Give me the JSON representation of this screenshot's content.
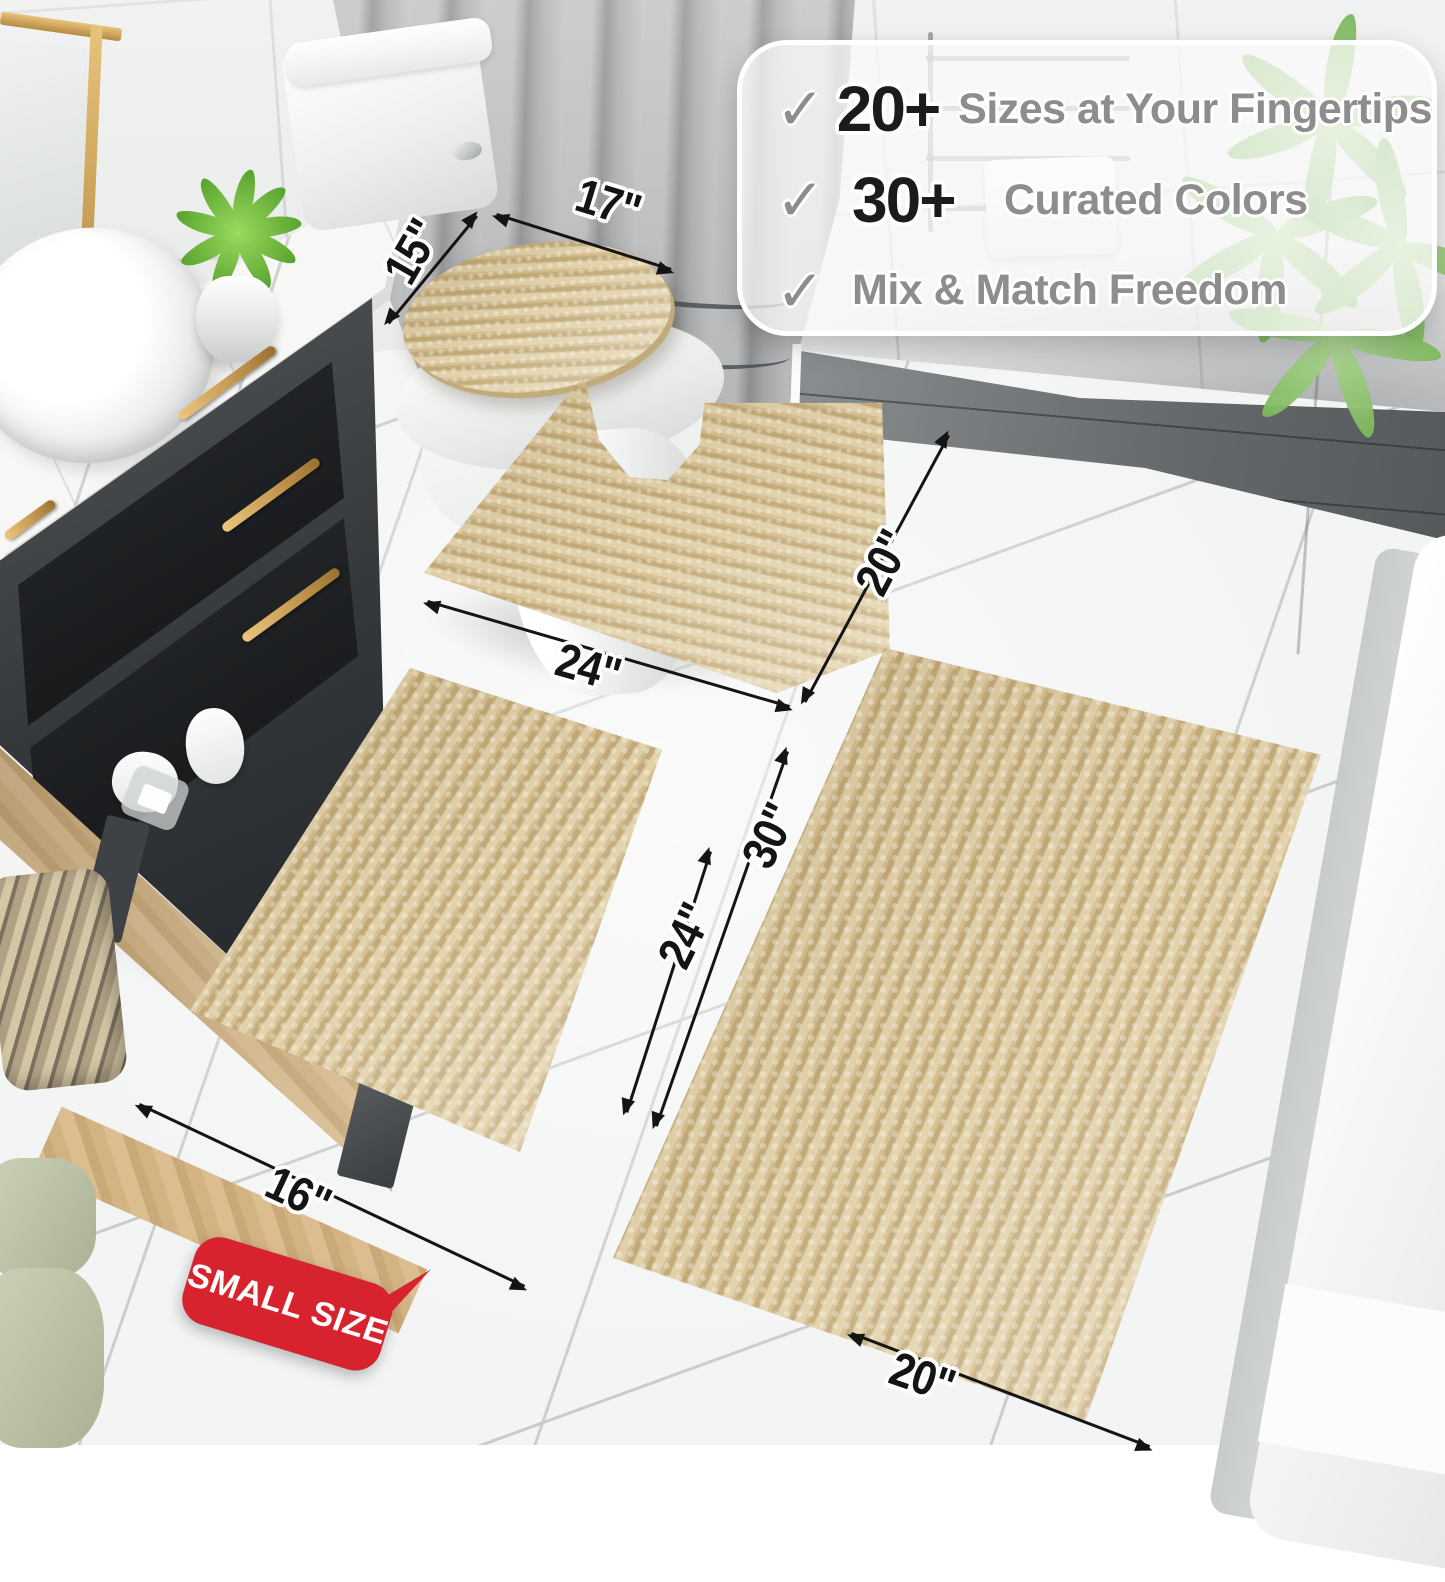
{
  "callout": {
    "check": "✓",
    "items": [
      {
        "stat": "20+",
        "label": "Sizes at Your Fingertips"
      },
      {
        "stat": "30+",
        "label": "Curated Colors"
      },
      {
        "stat": "",
        "label": "Mix & Match Freedom"
      }
    ]
  },
  "dimensions": {
    "lid_width": "17\"",
    "lid_depth": "15\"",
    "contour_side": "20\"",
    "contour_width": "24\"",
    "small_length": "24\"",
    "small_width": "16\"",
    "large_length": "30\"",
    "large_width": "20\""
  },
  "badge": {
    "text": "SMALL SIZE"
  },
  "colors": {
    "rug_beige": "#d5c094",
    "rug_stripe_dark": "#c3ab79",
    "rug_stripe_light": "#e2d2ab",
    "badge_red": "#d6232e",
    "dim_ink": "#141414",
    "callout_stat": "#1b1b1b",
    "callout_gray": "#8d8d8d",
    "floor": "#f3f4f4",
    "wall": "#ebecec",
    "slate": "#6b6f72",
    "wood": "#d2b384",
    "plant_green": "#7cb85c"
  }
}
